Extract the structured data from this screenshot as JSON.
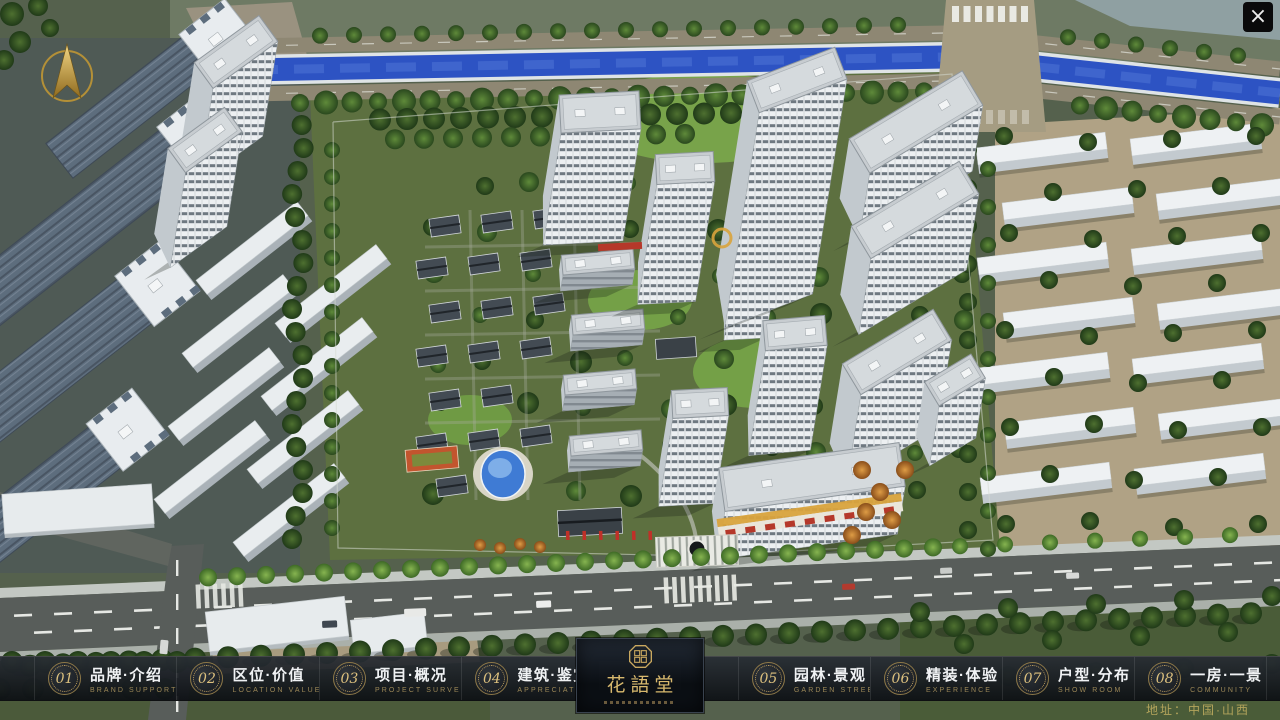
{
  "window": {
    "close_glyph": "×"
  },
  "icons": {
    "close": "x-mark",
    "compass": "north-arrow",
    "seal": "octagon-seal"
  },
  "nav": {
    "items": [
      {
        "num": "01",
        "zh": "品牌·介绍",
        "en": "BRAND SUPPORT"
      },
      {
        "num": "02",
        "zh": "区位·价值",
        "en": "LOCATION VALUE"
      },
      {
        "num": "03",
        "zh": "项目·概况",
        "en": "PROJECT SURVEY"
      },
      {
        "num": "04",
        "zh": "建筑·鉴赏",
        "en": "APPRECIATION"
      },
      {
        "num": "05",
        "zh": "园林·景观",
        "en": "GARDEN STREET"
      },
      {
        "num": "06",
        "zh": "精装·体验",
        "en": "EXPERIENCE"
      },
      {
        "num": "07",
        "zh": "户型·分布",
        "en": "SHOW ROOM"
      },
      {
        "num": "08",
        "zh": "一房·一景",
        "en": "COMMUNITY"
      }
    ]
  },
  "logo": {
    "name_zh": "花語堂"
  },
  "footer": {
    "address": "地址：中国·山西"
  },
  "colors": {
    "accent_gold": "#c9a85f",
    "gold_bright": "#dcc07e",
    "bar_bg": "#14181d",
    "text_primary": "#f0f2f4",
    "text_sub_gold": "#9b8757",
    "water_blue": "#2d53c3",
    "tree_green": "#2e4a26",
    "lawn_green": "#78a34a",
    "road_gray": "#585d5a",
    "tower_white": "#eef1f3",
    "ground_tan": "#b0a285"
  }
}
